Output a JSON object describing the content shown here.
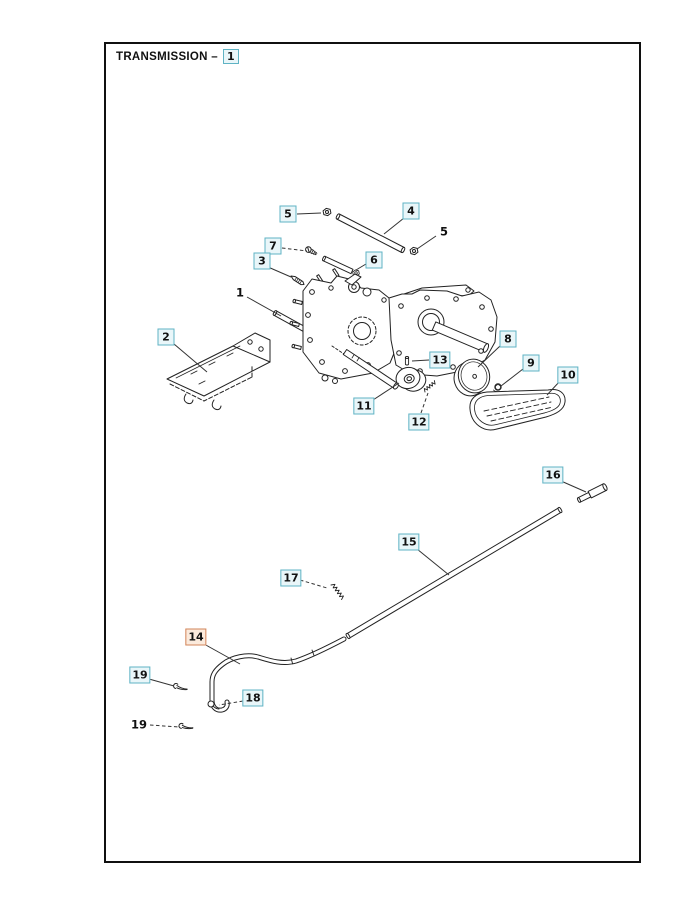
{
  "page": {
    "title": "TRANSMISSION –",
    "title_ref": "1"
  },
  "colors": {
    "teal_border": "#5fb3c4",
    "teal_bg": "#e9f6f9",
    "orange_border": "#d2845a",
    "orange_bg": "#fbeadc",
    "ink": "#222222",
    "leader": "#333333"
  },
  "callouts": [
    {
      "label": "5",
      "style": "teal",
      "x": 288,
      "y": 214,
      "leader": {
        "x1": 297,
        "y1": 214,
        "x2": 321,
        "y2": 213,
        "dashed": false
      }
    },
    {
      "label": "4",
      "style": "teal",
      "x": 411,
      "y": 211,
      "leader": {
        "x1": 404,
        "y1": 218,
        "x2": 384,
        "y2": 234,
        "dashed": false
      }
    },
    {
      "label": "5",
      "style": "plain",
      "x": 444,
      "y": 231,
      "leader": {
        "x1": 436,
        "y1": 236,
        "x2": 417,
        "y2": 249,
        "dashed": false
      }
    },
    {
      "label": "7",
      "style": "teal",
      "x": 273,
      "y": 246,
      "leader": {
        "x1": 282,
        "y1": 248,
        "x2": 307,
        "y2": 251,
        "dashed": true
      }
    },
    {
      "label": "3",
      "style": "teal",
      "x": 262,
      "y": 261,
      "leader": {
        "x1": 268,
        "y1": 267,
        "x2": 291,
        "y2": 277,
        "dashed": false
      }
    },
    {
      "label": "6",
      "style": "teal",
      "x": 374,
      "y": 260,
      "leader": {
        "x1": 366,
        "y1": 264,
        "x2": 356,
        "y2": 270,
        "dashed": false
      }
    },
    {
      "label": "1",
      "style": "plain",
      "x": 240,
      "y": 292,
      "leader": {
        "x1": 247,
        "y1": 297,
        "x2": 281,
        "y2": 316,
        "dashed": false
      }
    },
    {
      "label": "2",
      "style": "teal",
      "x": 166,
      "y": 337,
      "leader": {
        "x1": 174,
        "y1": 344,
        "x2": 207,
        "y2": 372,
        "dashed": false
      }
    },
    {
      "label": "8",
      "style": "teal",
      "x": 508,
      "y": 339,
      "leader": {
        "x1": 500,
        "y1": 346,
        "x2": 478,
        "y2": 367,
        "dashed": false
      }
    },
    {
      "label": "9",
      "style": "teal",
      "x": 531,
      "y": 363,
      "leader": {
        "x1": 523,
        "y1": 369,
        "x2": 501,
        "y2": 386,
        "dashed": false
      }
    },
    {
      "label": "10",
      "style": "teal",
      "x": 568,
      "y": 375,
      "leader": {
        "x1": 560,
        "y1": 381,
        "x2": 547,
        "y2": 395,
        "dashed": false
      }
    },
    {
      "label": "13",
      "style": "teal",
      "x": 440,
      "y": 360,
      "leader": {
        "x1": 429,
        "y1": 360,
        "x2": 412,
        "y2": 361,
        "dashed": false
      }
    },
    {
      "label": "11",
      "style": "teal",
      "x": 364,
      "y": 406,
      "leader": {
        "x1": 373,
        "y1": 400,
        "x2": 399,
        "y2": 383,
        "dashed": false
      }
    },
    {
      "label": "12",
      "style": "teal",
      "x": 419,
      "y": 422,
      "leader": {
        "x1": 421,
        "y1": 413,
        "x2": 428,
        "y2": 393,
        "dashed": true
      }
    },
    {
      "label": "16",
      "style": "teal",
      "x": 553,
      "y": 475,
      "leader": {
        "x1": 561,
        "y1": 481,
        "x2": 586,
        "y2": 492,
        "dashed": false
      }
    },
    {
      "label": "15",
      "style": "teal",
      "x": 409,
      "y": 542,
      "leader": {
        "x1": 417,
        "y1": 549,
        "x2": 449,
        "y2": 575,
        "dashed": false
      }
    },
    {
      "label": "17",
      "style": "teal",
      "x": 291,
      "y": 578,
      "leader": {
        "x1": 300,
        "y1": 580,
        "x2": 327,
        "y2": 588,
        "dashed": true
      }
    },
    {
      "label": "14",
      "style": "orange",
      "x": 196,
      "y": 637,
      "leader": {
        "x1": 204,
        "y1": 644,
        "x2": 240,
        "y2": 664,
        "dashed": false
      }
    },
    {
      "label": "19",
      "style": "teal",
      "x": 140,
      "y": 675,
      "leader": {
        "x1": 149,
        "y1": 679,
        "x2": 174,
        "y2": 686,
        "dashed": false
      }
    },
    {
      "label": "18",
      "style": "teal",
      "x": 253,
      "y": 698,
      "leader": {
        "x1": 243,
        "y1": 701,
        "x2": 219,
        "y2": 705,
        "dashed": true
      }
    },
    {
      "label": "19",
      "style": "plain",
      "x": 139,
      "y": 724,
      "leader": {
        "x1": 150,
        "y1": 725,
        "x2": 179,
        "y2": 727,
        "dashed": true
      }
    }
  ]
}
